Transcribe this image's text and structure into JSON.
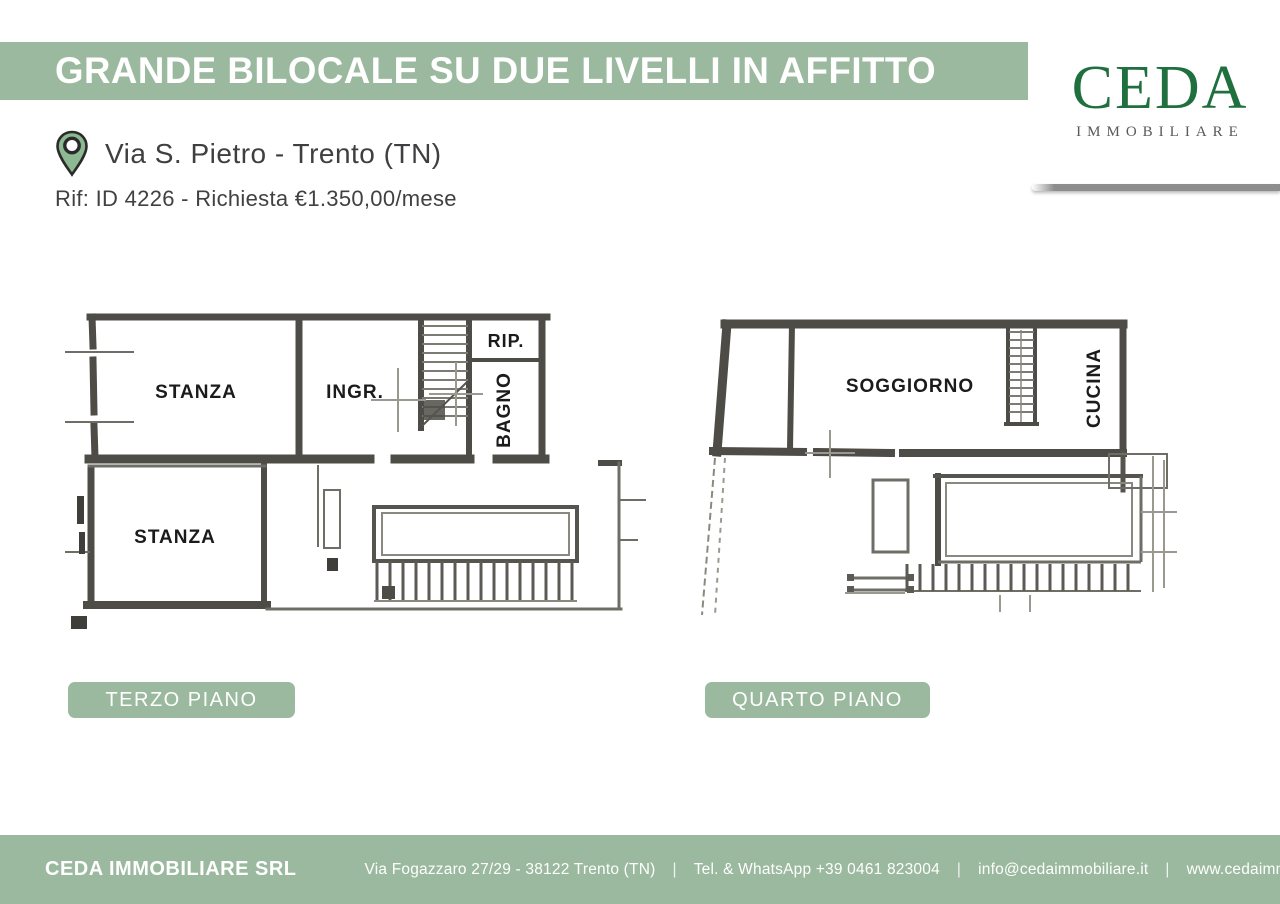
{
  "header": {
    "title": "GRANDE BILOCALE SU DUE LIVELLI IN AFFITTO"
  },
  "logo": {
    "wordmark": "CEDA",
    "subtitle": "IMMOBILIARE"
  },
  "listing": {
    "location": "Via S. Pietro - Trento (TN)",
    "reference": "Rif: ID 4226 - Richiesta €1.350,00/mese"
  },
  "floorplans": {
    "terzo": {
      "label": "TERZO PIANO",
      "rooms": {
        "stanza1": "STANZA",
        "ingresso": "INGR.",
        "ripostiglio": "RIP.",
        "bagno": "BAGNO",
        "stanza2": "STANZA"
      }
    },
    "quarto": {
      "label": "QUARTO PIANO",
      "rooms": {
        "soggiorno": "SOGGIORNO",
        "cucina": "CUCINA"
      }
    }
  },
  "footer": {
    "company": "CEDA IMMOBILIARE SRL",
    "address": "Via Fogazzaro 27/29 - 38122 Trento (TN)",
    "phone": "Tel. & WhatsApp +39 0461 823004",
    "email": "info@cedaimmobiliare.it",
    "website": "www.cedaimmobiliare.it",
    "separator": "|"
  },
  "colors": {
    "accent_green": "#9bb99e",
    "logo_green": "#20703f",
    "pin_green": "#8cb892",
    "text_dark": "#414042",
    "plan_wall": "#4d4c47"
  }
}
